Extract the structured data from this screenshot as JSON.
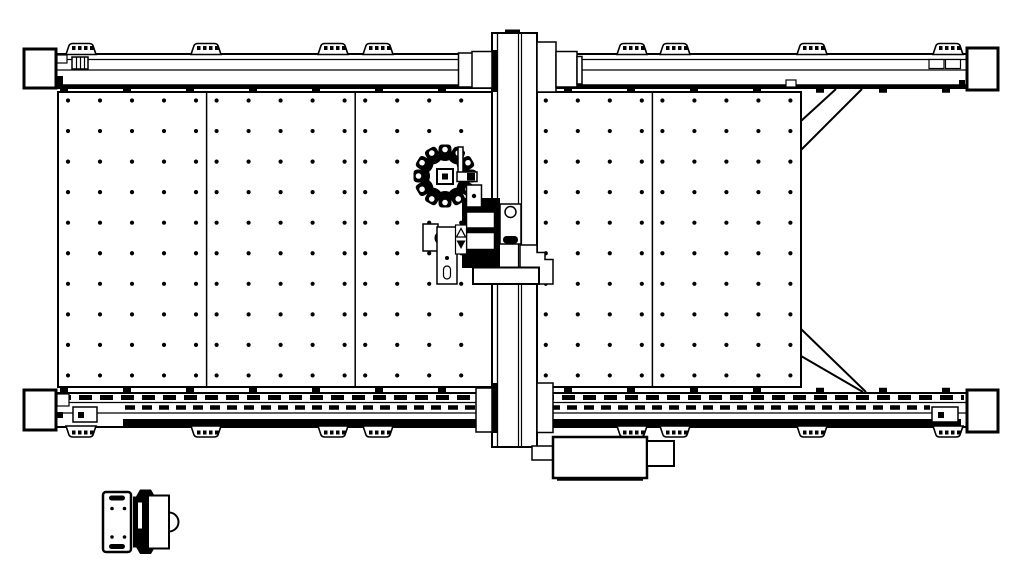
{
  "meta": {
    "description": "cnc-gantry-machine-plan-view-cad-drawing",
    "ink": "#000000",
    "background": "#ffffff"
  },
  "canvas": {
    "w": 1024,
    "h": 576
  },
  "components": [
    {
      "name": "work-table",
      "type": "prims",
      "prims": [
        {
          "t": "rect",
          "x": 58,
          "y": 92,
          "w": 743,
          "h": 295,
          "sw": 2
        },
        {
          "t": "line",
          "x1": 206.6,
          "y1": 92,
          "x2": 206.6,
          "y2": 387,
          "sw": 1.5
        },
        {
          "t": "line",
          "x1": 355.2,
          "y1": 92,
          "x2": 355.2,
          "y2": 387,
          "sw": 1.5
        },
        {
          "t": "line",
          "x1": 503.8,
          "y1": 92,
          "x2": 503.8,
          "y2": 387,
          "sw": 1.5
        },
        {
          "t": "line",
          "x1": 652.4,
          "y1": 92,
          "x2": 652.4,
          "y2": 387,
          "sw": 1.5
        }
      ]
    },
    {
      "name": "table-dot-grid",
      "type": "dots",
      "spec": {
        "panels": [
          58,
          206.6,
          355.2,
          503.8,
          652.4
        ],
        "col_offset": 10,
        "col_step": 32,
        "cols": 5,
        "y_start": 100.5,
        "y_step": 30.55,
        "rows": 10,
        "r": 2.1
      }
    },
    {
      "name": "right-frame-braces",
      "type": "prims",
      "prims": [
        {
          "t": "line",
          "x1": 836,
          "y1": 89,
          "x2": 801,
          "y2": 121,
          "sw": 2
        },
        {
          "t": "line",
          "x1": 862,
          "y1": 89,
          "x2": 801,
          "y2": 150,
          "sw": 2
        },
        {
          "t": "line",
          "x1": 801,
          "y1": 329,
          "x2": 866,
          "y2": 392,
          "sw": 2
        },
        {
          "t": "line",
          "x1": 801,
          "y1": 356,
          "x2": 863,
          "y2": 392,
          "sw": 2
        }
      ]
    },
    {
      "name": "top-rail",
      "type": "prims",
      "prims": [
        {
          "t": "rect",
          "x": 56,
          "y": 54,
          "w": 911,
          "h": 34,
          "sw": 2
        },
        {
          "t": "line",
          "x1": 56,
          "y1": 59.5,
          "x2": 967,
          "y2": 59.5,
          "sw": 1.2
        },
        {
          "t": "line",
          "x1": 56,
          "y1": 70,
          "x2": 967,
          "y2": 70,
          "sw": 1.2
        },
        {
          "t": "line",
          "x1": 56,
          "y1": 86,
          "x2": 967,
          "y2": 86,
          "sw": 3.5
        },
        {
          "t": "line",
          "x1": 60,
          "y1": 90.5,
          "x2": 960,
          "y2": 90.5,
          "sw": 4.5,
          "dash": "8 55"
        },
        {
          "t": "rect",
          "x": 72,
          "y": 57,
          "w": 16,
          "h": 12,
          "sw": 1.5
        },
        {
          "t": "line",
          "x1": 76.5,
          "y1": 57,
          "x2": 76.5,
          "y2": 69,
          "sw": 1.2
        },
        {
          "t": "line",
          "x1": 80.5,
          "y1": 57,
          "x2": 80.5,
          "y2": 69,
          "sw": 1.2
        },
        {
          "t": "line",
          "x1": 84.5,
          "y1": 57,
          "x2": 84.5,
          "y2": 69,
          "sw": 1.2
        },
        {
          "t": "rect",
          "x": 929,
          "y": 59.5,
          "w": 15,
          "h": 9,
          "sw": 1.2
        },
        {
          "t": "rect",
          "x": 945.5,
          "y": 59.5,
          "w": 15,
          "h": 9,
          "sw": 1.2
        },
        {
          "t": "rect",
          "x": 57,
          "y": 55,
          "w": 10,
          "h": 8,
          "sw": 1.2
        },
        {
          "t": "rect",
          "x": 56,
          "y": 76,
          "w": 7,
          "h": 10,
          "f": "ink"
        },
        {
          "t": "rect",
          "x": 786,
          "y": 80,
          "w": 10,
          "h": 7,
          "sw": 1.2
        },
        {
          "t": "rect",
          "x": 959,
          "y": 80,
          "w": 6,
          "h": 6,
          "f": "ink"
        }
      ]
    },
    {
      "name": "top-rail-feet",
      "type": "feet",
      "spec": {
        "xs": [
          66,
          191,
          318,
          363,
          617,
          660,
          797,
          933
        ],
        "y": 43.5,
        "w": 30,
        "h": 11,
        "dir": "up"
      }
    },
    {
      "name": "bottom-rail",
      "type": "prims",
      "prims": [
        {
          "t": "rect",
          "x": 56,
          "y": 393,
          "w": 911,
          "h": 34,
          "sw": 2
        },
        {
          "t": "line",
          "x1": 60,
          "y1": 390,
          "x2": 960,
          "y2": 390,
          "sw": 4.5,
          "dash": "8 55"
        },
        {
          "t": "line",
          "x1": 58,
          "y1": 397.5,
          "x2": 964,
          "y2": 397.5,
          "sw": 5,
          "dash": "13 8"
        },
        {
          "t": "line",
          "x1": 56,
          "y1": 402.5,
          "x2": 967,
          "y2": 402.5,
          "sw": 1.2
        },
        {
          "t": "line",
          "x1": 125,
          "y1": 407.5,
          "x2": 930,
          "y2": 407.5,
          "sw": 4.5,
          "dash": "10 7"
        },
        {
          "t": "line",
          "x1": 56,
          "y1": 413,
          "x2": 967,
          "y2": 413,
          "sw": 1.2
        },
        {
          "t": "rect",
          "x": 123,
          "y": 419,
          "w": 838,
          "h": 7,
          "f": "ink"
        },
        {
          "t": "rect",
          "x": 73,
          "y": 407,
          "w": 24,
          "h": 15,
          "sw": 1.5
        },
        {
          "t": "rect",
          "x": 78,
          "y": 412,
          "w": 6,
          "h": 6,
          "f": "ink"
        },
        {
          "t": "rect",
          "x": 932,
          "y": 407,
          "w": 26,
          "h": 15,
          "sw": 1.5
        },
        {
          "t": "rect",
          "x": 938,
          "y": 412,
          "w": 6,
          "h": 6,
          "f": "ink"
        },
        {
          "t": "rect",
          "x": 57,
          "y": 394,
          "w": 12,
          "h": 12,
          "sw": 1.2
        },
        {
          "t": "rect",
          "x": 57,
          "y": 412,
          "w": 6,
          "h": 6,
          "f": "ink"
        }
      ]
    },
    {
      "name": "bottom-rail-feet",
      "type": "feet",
      "spec": {
        "xs": [
          66,
          191,
          318,
          363,
          617,
          660,
          797,
          933
        ],
        "y": 426,
        "w": 30,
        "h": 11,
        "dir": "down"
      }
    },
    {
      "name": "corner-blocks",
      "type": "prims",
      "prims": [
        {
          "t": "rect",
          "x": 24,
          "y": 49,
          "w": 32,
          "h": 39,
          "sw": 3
        },
        {
          "t": "rect",
          "x": 967,
          "y": 48,
          "w": 31,
          "h": 42,
          "sw": 3
        },
        {
          "t": "rect",
          "x": 24,
          "y": 390,
          "w": 32,
          "h": 40,
          "sw": 3
        },
        {
          "t": "rect",
          "x": 967,
          "y": 390,
          "w": 31,
          "h": 42,
          "sw": 3
        }
      ]
    },
    {
      "name": "gantry",
      "type": "prims",
      "prims": [
        {
          "t": "rect",
          "x": 492,
          "y": 33,
          "w": 45,
          "h": 414,
          "sw": 2
        },
        {
          "t": "line",
          "x1": 497.5,
          "y1": 33,
          "x2": 497.5,
          "y2": 447,
          "sw": 1.3
        },
        {
          "t": "line",
          "x1": 518.5,
          "y1": 33,
          "x2": 518.5,
          "y2": 447,
          "sw": 1.2
        },
        {
          "t": "line",
          "x1": 521.5,
          "y1": 33,
          "x2": 521.5,
          "y2": 447,
          "sw": 1.2
        },
        {
          "t": "rect",
          "x": 491,
          "y": 50,
          "w": 7,
          "h": 42,
          "f": "ink"
        },
        {
          "t": "rect",
          "x": 491,
          "y": 383,
          "w": 7,
          "h": 50,
          "f": "ink"
        },
        {
          "t": "rect",
          "x": 505,
          "y": 29.5,
          "w": 15,
          "h": 4.5,
          "f": "ink"
        },
        {
          "t": "rect",
          "x": 458.5,
          "y": 53,
          "w": 14,
          "h": 34,
          "sw": 1.5
        },
        {
          "t": "rect",
          "x": 472,
          "y": 51.5,
          "w": 20,
          "h": 36.5,
          "sw": 1.5
        },
        {
          "t": "rect",
          "x": 537,
          "y": 42,
          "w": 19,
          "h": 50,
          "sw": 1.5
        },
        {
          "t": "rect",
          "x": 556,
          "y": 51.5,
          "w": 21,
          "h": 35.5,
          "sw": 1.5
        },
        {
          "t": "rect",
          "x": 577,
          "y": 56.5,
          "w": 5,
          "h": 27.5,
          "sw": 1.5
        },
        {
          "t": "rect",
          "x": 476,
          "y": 388,
          "w": 16,
          "h": 44,
          "sw": 1.5
        },
        {
          "t": "rect",
          "x": 537,
          "y": 383,
          "w": 16,
          "h": 49.5,
          "sw": 1.5
        },
        {
          "t": "rect",
          "x": 532,
          "y": 446,
          "w": 21,
          "h": 14,
          "sw": 1.5
        },
        {
          "t": "rect",
          "x": 553,
          "y": 437,
          "w": 94,
          "h": 41,
          "sw": 2.5
        },
        {
          "t": "rect",
          "x": 647,
          "y": 441,
          "w": 27,
          "h": 25,
          "sw": 2
        },
        {
          "t": "line",
          "x1": 557,
          "y1": 479.5,
          "x2": 643,
          "y2": 479.5,
          "sw": 2.5
        }
      ]
    },
    {
      "name": "spindle-head",
      "type": "prims",
      "prims": [
        {
          "t": "rect",
          "x": 462,
          "y": 198,
          "w": 38,
          "h": 70,
          "f": "ink"
        },
        {
          "t": "rect",
          "x": 466.5,
          "y": 212,
          "w": 28,
          "h": 16,
          "sw": 1.5
        },
        {
          "t": "rect",
          "x": 466.5,
          "y": 232.5,
          "w": 28,
          "h": 17,
          "sw": 1.5
        },
        {
          "t": "rect",
          "x": 500,
          "y": 204,
          "w": 21,
          "h": 40,
          "sw": 1.5
        },
        {
          "t": "circle",
          "cx": 510.5,
          "cy": 212,
          "r": 5.5,
          "f": "#ffffff",
          "sw": 1.5
        },
        {
          "t": "rect",
          "x": 503,
          "y": 236,
          "w": 15,
          "h": 7.5,
          "rx": 3.5,
          "f": "ink"
        },
        {
          "t": "rect",
          "x": 423,
          "y": 224,
          "w": 15,
          "h": 27,
          "sw": 1.5
        },
        {
          "t": "circle",
          "cx": 441.5,
          "cy": 238,
          "r": 7,
          "f": "ink"
        },
        {
          "t": "circle",
          "cx": 441.5,
          "cy": 238,
          "r": 2.8,
          "f": "#ffffff"
        },
        {
          "t": "rect",
          "x": 437,
          "y": 227,
          "w": 20,
          "h": 57,
          "sw": 1.5
        },
        {
          "t": "circle",
          "cx": 447,
          "cy": 258,
          "r": 2,
          "f": "ink"
        },
        {
          "t": "rect",
          "x": 443.5,
          "y": 266,
          "w": 7,
          "h": 13,
          "rx": 3.5,
          "sw": 1.2
        },
        {
          "t": "rect",
          "x": 455.5,
          "y": 225,
          "w": 11,
          "h": 29,
          "sw": 1.2
        },
        {
          "t": "path",
          "d": "M461,228.5 L456.5,237 L465.5,237 Z",
          "f": "#ffffff",
          "sw": 1.3
        },
        {
          "t": "path",
          "d": "M456.5,240.5 L465.5,240.5 L461,249 Z",
          "f": "ink"
        },
        {
          "t": "path",
          "d": "M520,245 L537,245 L537,252.5 L545,252.5 L545,259.5 L553,259.5 L553,284 L520,284 Z",
          "f": "#ffffff",
          "sw": 1.5
        },
        {
          "t": "rect",
          "x": 473,
          "y": 267.5,
          "w": 66,
          "h": 16.5,
          "sw": 2
        }
      ]
    },
    {
      "name": "tool-carousel",
      "type": "star",
      "spec": {
        "cx": 445,
        "cy": 176,
        "pockets": 12,
        "notch_r": 2.8,
        "notch_y": -26.5,
        "petal": "M-6.5,-17 L-6.5,-27 Q-6.5,-31.5 -2.8,-31.5 L2.8,-31.5 Q6.5,-31.5 6.5,-27 L6.5,-17 Q0,-13 -6.5,-17 Z"
      }
    },
    {
      "name": "tool-carousel-bracket",
      "type": "prims",
      "prims": [
        {
          "t": "rect",
          "x": 458,
          "y": 147,
          "w": 5,
          "h": 30,
          "sw": 1.5
        },
        {
          "t": "rect",
          "x": 437,
          "y": 169,
          "w": 16,
          "h": 15,
          "sw": 2
        },
        {
          "t": "rect",
          "x": 442,
          "y": 173.5,
          "w": 6,
          "h": 6,
          "f": "ink"
        },
        {
          "t": "rect",
          "x": 457,
          "y": 172,
          "w": 20,
          "h": 9.5,
          "sw": 1.5
        },
        {
          "t": "rect",
          "x": 467,
          "y": 173,
          "w": 8,
          "h": 7.5,
          "f": "ink"
        },
        {
          "t": "rect",
          "x": 466.5,
          "y": 185,
          "w": 15,
          "h": 22,
          "sw": 1.5
        },
        {
          "t": "circle",
          "cx": 474,
          "cy": 196,
          "r": 2.2,
          "f": "ink"
        }
      ]
    },
    {
      "name": "pendant-unit",
      "type": "prims",
      "prims": [
        {
          "t": "path",
          "d": "M136,496.5 L140,489.5 L151,489.5 L155,496.5 Z",
          "f": "ink"
        },
        {
          "t": "path",
          "d": "M136,547 L155,547 L151,554 L140,554 Z",
          "f": "ink"
        },
        {
          "t": "rect",
          "x": 103,
          "y": 492,
          "w": 28,
          "h": 60,
          "rx": 3,
          "sw": 2.5
        },
        {
          "t": "rect",
          "x": 109,
          "y": 495.5,
          "w": 16,
          "h": 5,
          "rx": 2.5,
          "f": "ink"
        },
        {
          "t": "rect",
          "x": 109,
          "y": 544,
          "w": 16,
          "h": 5,
          "rx": 2.5,
          "f": "ink"
        },
        {
          "t": "circle",
          "cx": 112,
          "cy": 508.5,
          "r": 1.8,
          "f": "ink"
        },
        {
          "t": "circle",
          "cx": 124.5,
          "cy": 508.5,
          "r": 1.8,
          "f": "ink"
        },
        {
          "t": "circle",
          "cx": 112,
          "cy": 537,
          "r": 1.8,
          "f": "ink"
        },
        {
          "t": "circle",
          "cx": 124.5,
          "cy": 537,
          "r": 1.8,
          "f": "ink"
        },
        {
          "t": "rect",
          "x": 133,
          "y": 496.5,
          "w": 15,
          "h": 51,
          "f": "ink"
        },
        {
          "t": "rect",
          "x": 138,
          "y": 502.5,
          "w": 4,
          "h": 26,
          "f": "#ffffff"
        },
        {
          "t": "rect",
          "x": 148,
          "y": 495.5,
          "w": 21,
          "h": 53,
          "sw": 2
        },
        {
          "t": "path",
          "d": "M169,512.5 A9.5,9.5 0 0 1 169,531.5 Z",
          "f": "#ffffff",
          "sw": 2
        }
      ]
    }
  ]
}
